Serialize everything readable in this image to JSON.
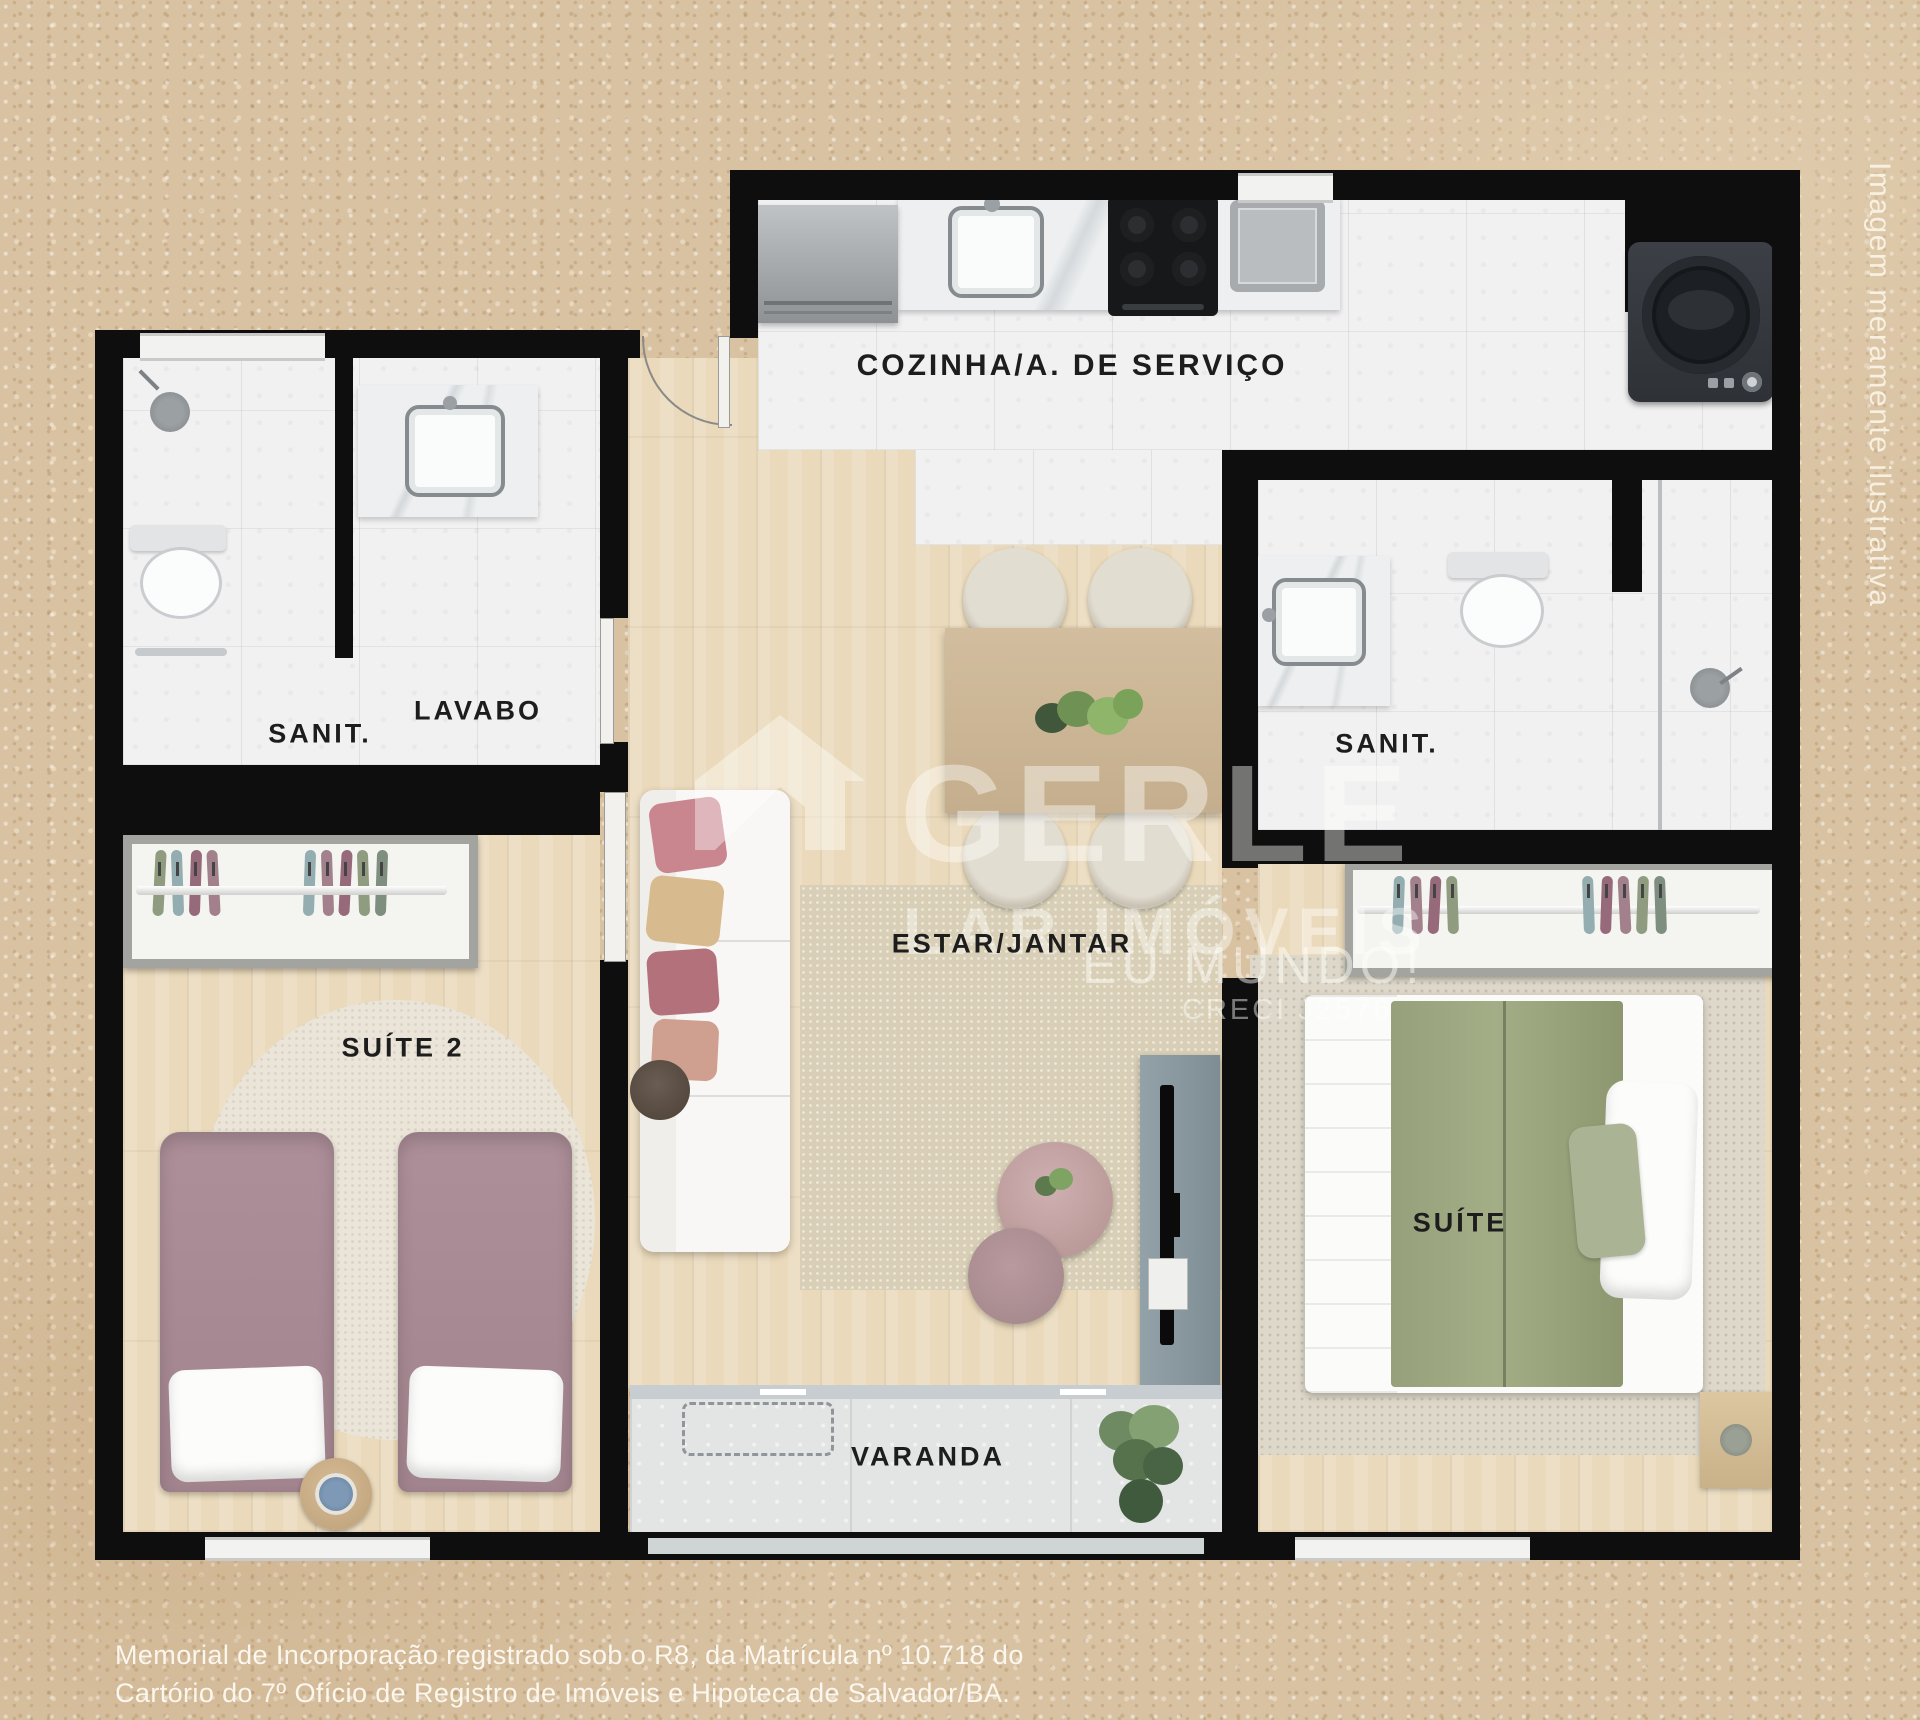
{
  "meta": {
    "side_note": "Imagem meramente ilustrativa",
    "disclaimer": [
      "Memorial de Incorporação registrado sob o R8, da Matrícula nº 10.718 do",
      "Cartório do 7º Ofício de Registro de Imóveis e Hipoteca de Salvador/BA."
    ]
  },
  "watermark": {
    "brand": "GERLE",
    "subtitle": "LAR IMÓVEIS",
    "tagline": "EU MUNDO!",
    "creci": "CRECI J2576"
  },
  "rooms": {
    "kitchen": {
      "label": "COZINHA/A. DE SERVIÇO"
    },
    "bath_left": {
      "label": "SANIT."
    },
    "lavabo": {
      "label": "LAVABO"
    },
    "living": {
      "label": "ESTAR/JANTAR"
    },
    "suite2": {
      "label": "SUÍTE 2"
    },
    "bath_right": {
      "label": "SANIT."
    },
    "suite": {
      "label": "SUÍTE"
    },
    "balcony": {
      "label": "VARANDA"
    }
  },
  "colors": {
    "sand_background": "#d8c2a2",
    "wall": "#0e0e0f",
    "wood_floor": "#ead9ba",
    "white_tile": "#f1f1f2",
    "balcony_tile": "#e3e5e5",
    "bed_mauve": "#a88b95",
    "bed_sage_green": "#9aa47e",
    "tv_panel_gray": "#8b9aa1",
    "rug_beige": "#d8cfb6",
    "watermark_white": "rgba(255,255,252,0.42)"
  }
}
